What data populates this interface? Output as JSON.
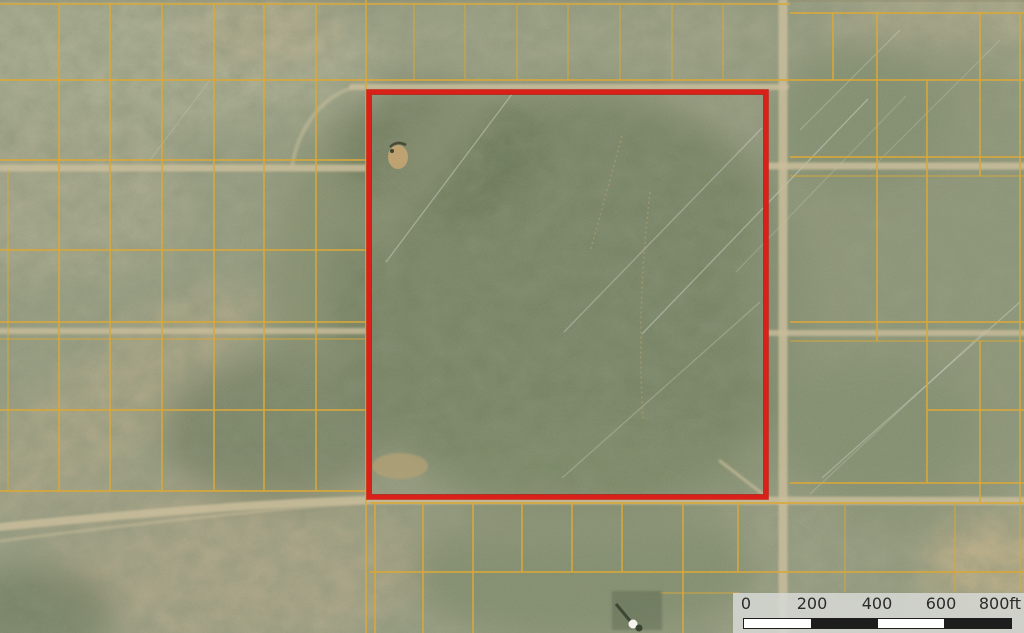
{
  "map": {
    "kind": "aerial-parcel-map",
    "subject_parcel": {
      "name": "subject-parcel-boundary",
      "outline_color": "#d92019"
    },
    "parcel_grid_line_color": "#d8a83b",
    "road_color": "#c9bd9b"
  },
  "scale_bar": {
    "labels": [
      "0",
      "200",
      "400",
      "600",
      "800ft"
    ],
    "values": [
      0,
      200,
      400,
      600,
      800
    ],
    "unit": "ft",
    "segment_pattern": [
      "light",
      "dark",
      "light",
      "dark"
    ]
  },
  "colors": {
    "base": "#9aa084",
    "parcel_line": "#d8a83b",
    "subject_outline": "#d92019",
    "road": "#c9bd9b",
    "scale_bg": "rgba(214,216,211,0.87)",
    "scale_text": "#2b2b2b",
    "scale_seg_light": "#ffffff",
    "scale_seg_dark": "#1d1d1d"
  }
}
